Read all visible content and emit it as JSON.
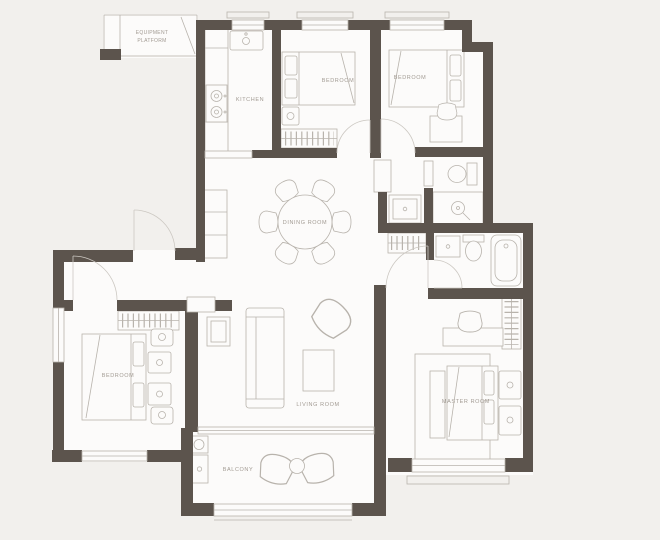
{
  "plan": {
    "title": "apartment-floor-plan",
    "rooms": {
      "equipment_platform": {
        "l1": "EQUIPMENT",
        "l2": "PLATFORM"
      },
      "kitchen": "KITCHEN",
      "bedroom_top_middle": "BEDROOM",
      "bedroom_top_right": "BEDROOM",
      "dining_room": "DINING ROOM",
      "bedroom_left": "BEDROOM",
      "living_room": "LIVING ROOM",
      "master_room": "MASTER ROOM",
      "balcony": "BALCONY"
    },
    "colors": {
      "background": "#f2f0ed",
      "floor": "#fcfbfa",
      "wall": "#5c544d",
      "line": "#b8b3ac",
      "label": "#a29b93"
    }
  }
}
